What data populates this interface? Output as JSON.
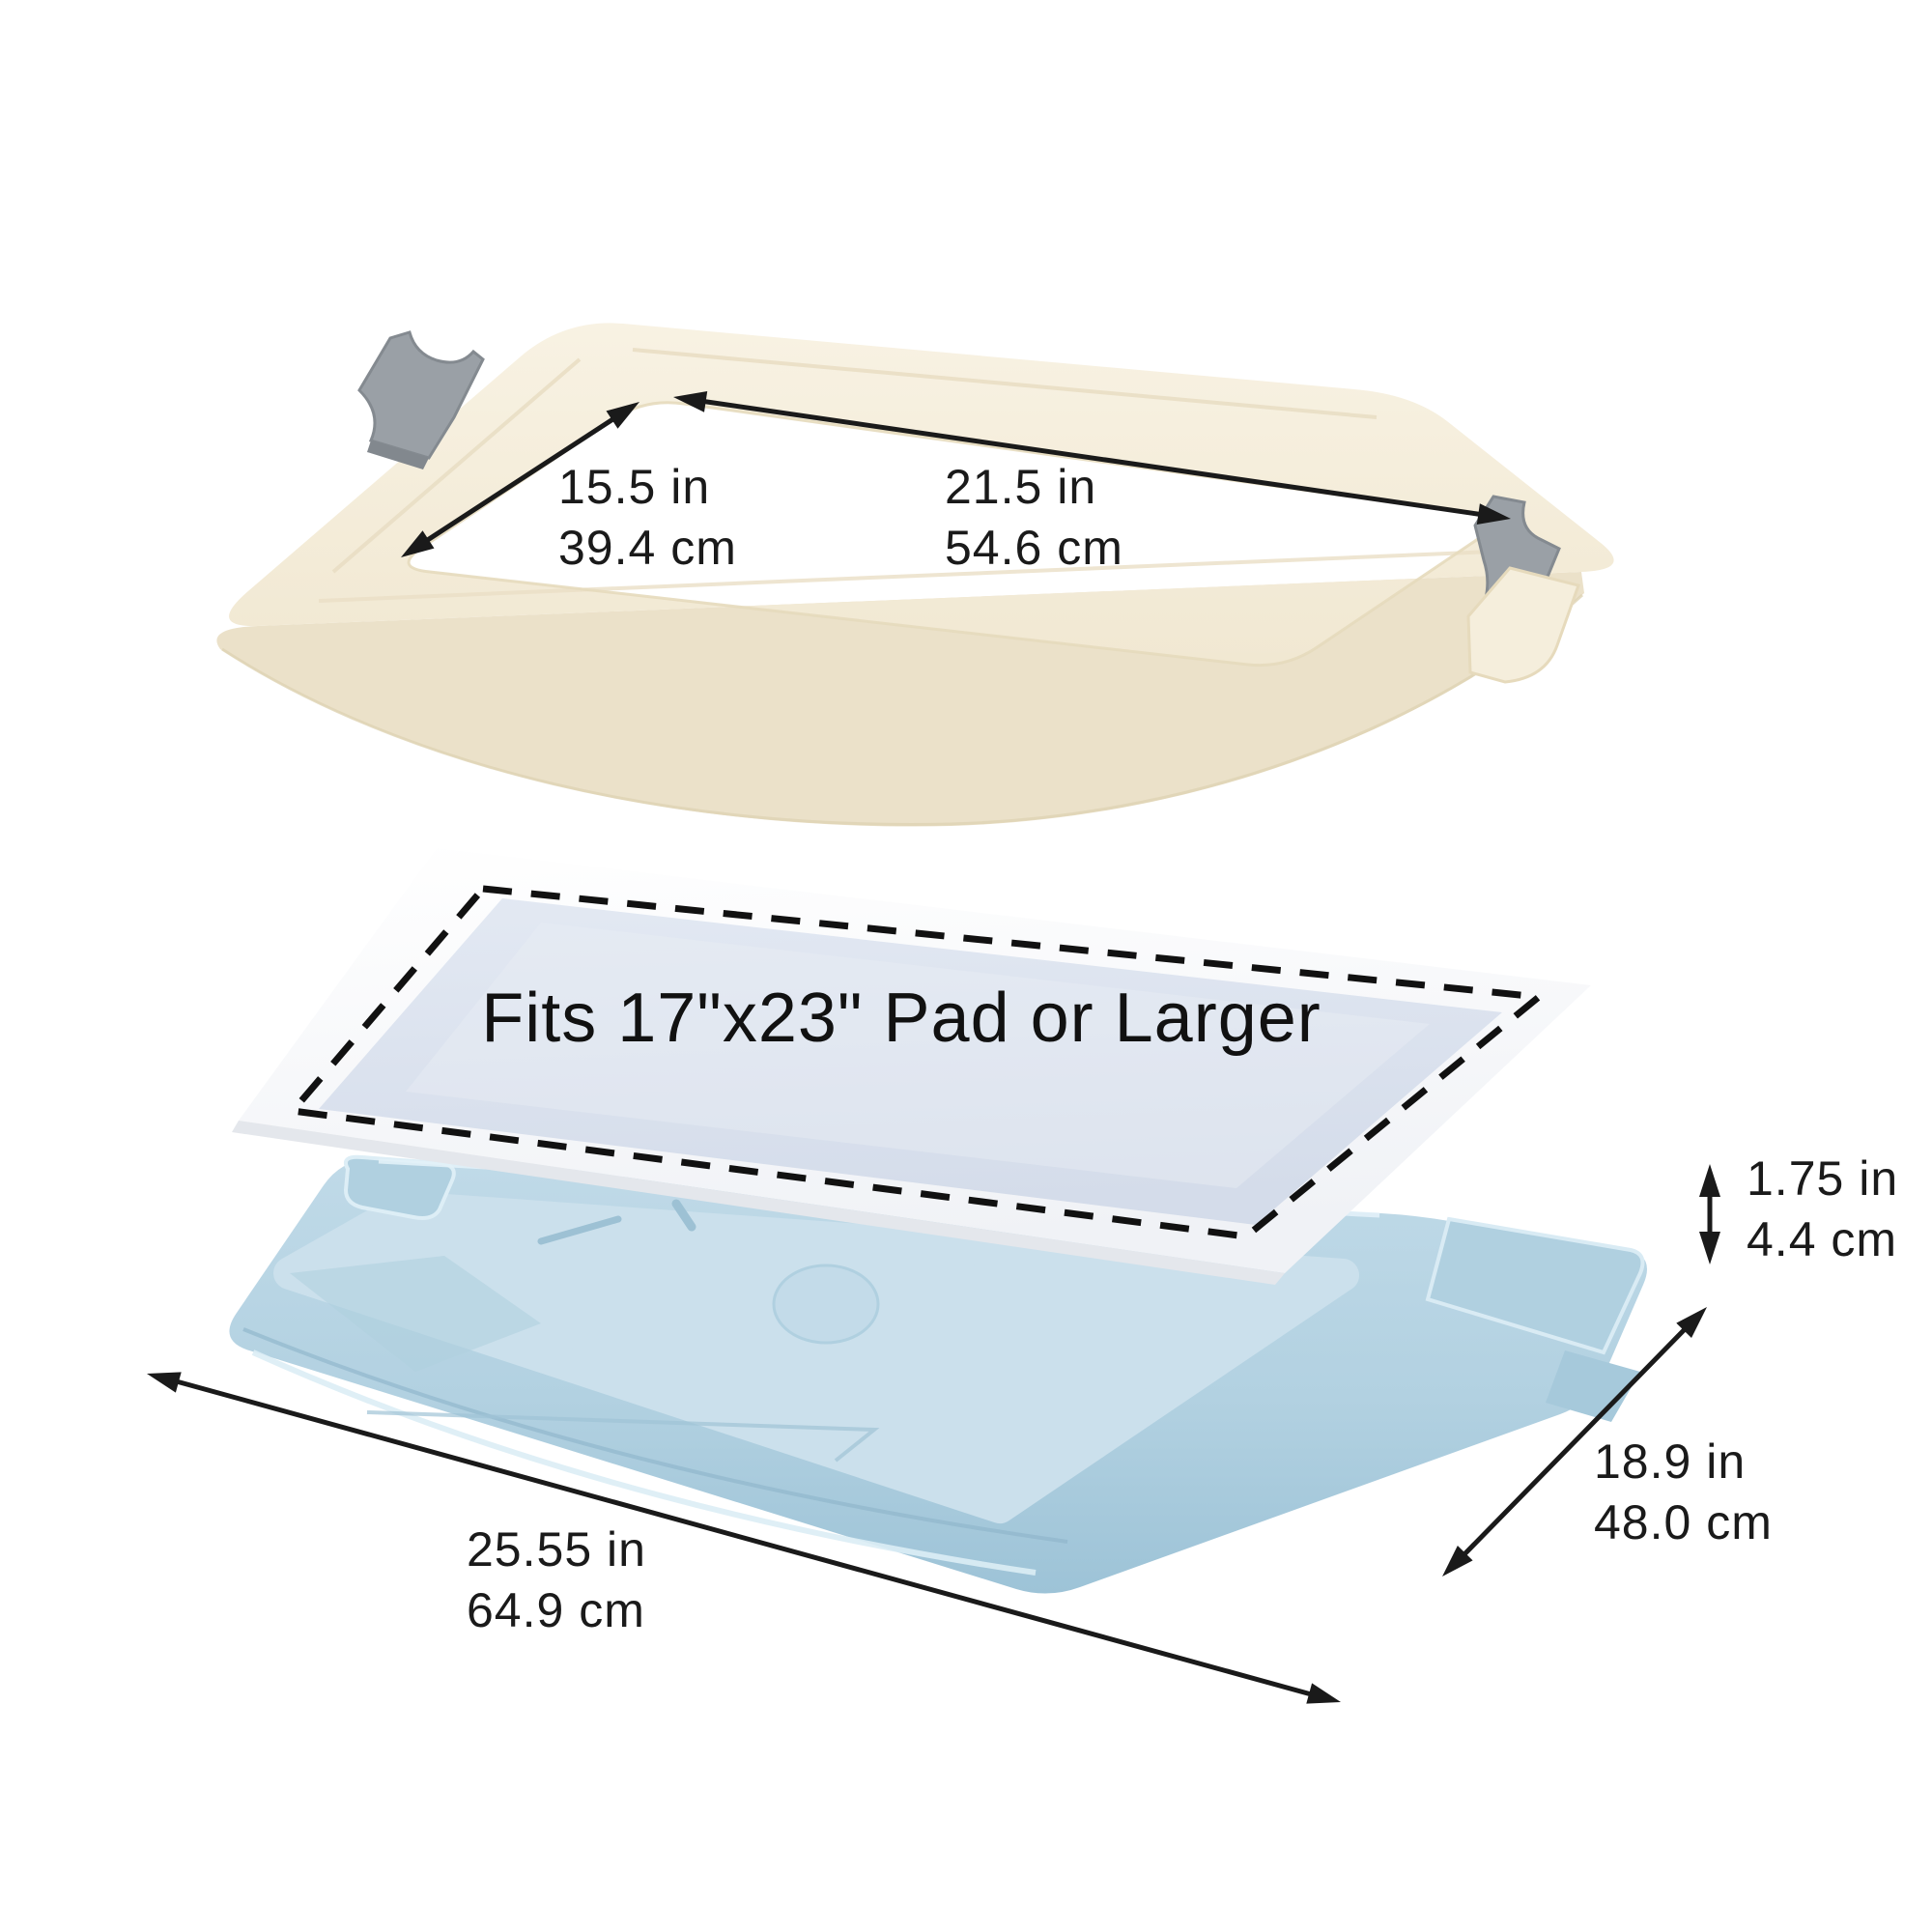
{
  "image": {
    "type": "product-dimension-diagram",
    "subject": "pet training pad holder tray (frame, disposable pad, tray base)",
    "background": "#ffffff"
  },
  "colors": {
    "text": "#1a1a1a",
    "arrow": "#1a1a1a",
    "dash": "#111111",
    "frame_top": "#f5eedc",
    "frame_wall": "#ebe1c9",
    "frame_edge": "#e0d5b8",
    "clip_gray": "#9aa0a6",
    "clip_gray_dark": "#82888e",
    "pad_sheet": "#fdfdfe",
    "pad_sheet_shade": "#eef0f4",
    "pad_core": "#dbe2ee",
    "tray_top": "#b7d4e3",
    "tray_floor": "#cbe0ec",
    "tray_deep": "#9cc2d6",
    "tray_ridge": "#dcedf5"
  },
  "pad_label": "Fits 17\"x23\" Pad or Larger",
  "dimensions": {
    "opening_width": {
      "inches": "15.5 in",
      "centimeters": "39.4 cm"
    },
    "opening_length": {
      "inches": "21.5 in",
      "centimeters": "54.6 cm"
    },
    "tray_height": {
      "inches": "1.75 in",
      "centimeters": "4.4 cm"
    },
    "tray_depth": {
      "inches": "18.9 in",
      "centimeters": "48.0 cm"
    },
    "tray_length": {
      "inches": "25.55 in",
      "centimeters": "64.9 cm"
    }
  }
}
